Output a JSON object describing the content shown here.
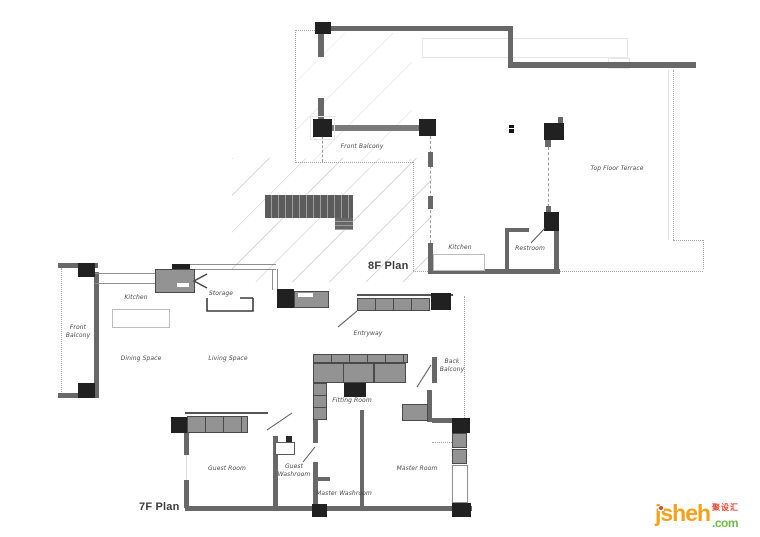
{
  "document": {
    "type": "residential floor plan drawing"
  },
  "colors": {
    "wall": "#686868",
    "column": "#212121",
    "cabinet": "#939393",
    "hatch": "#d9d9d9",
    "label_text": "#4b4b4b",
    "logo_orange": "#F7A11A",
    "logo_red": "#E8432D",
    "logo_green": "#6CBF45"
  },
  "plan_8f": {
    "title": "8F Plan",
    "labels": {
      "front_balcony": "Front Balcony",
      "top_floor_terrace": "Top Floor Terrace",
      "kitchen": "Kitchen",
      "restroom": "Restroom"
    }
  },
  "plan_7f": {
    "title": "7F Plan",
    "labels": {
      "front_balcony": "Front Balcony",
      "kitchen": "Kitchen",
      "storage": "Storage",
      "dining_space": "Dining Space",
      "living_space": "Living Space",
      "entryway": "Entryway",
      "back_balcony": "Back Balcony",
      "fitting_room": "Fitting Room",
      "guest_room": "Guest Room",
      "guest_washroom": "Guest Washroom",
      "master_washroom": "Master Washroom",
      "master_room": "Master Room"
    }
  },
  "watermark": {
    "name": "jsheh",
    "tld": ".com",
    "cjk": "聚设汇"
  }
}
